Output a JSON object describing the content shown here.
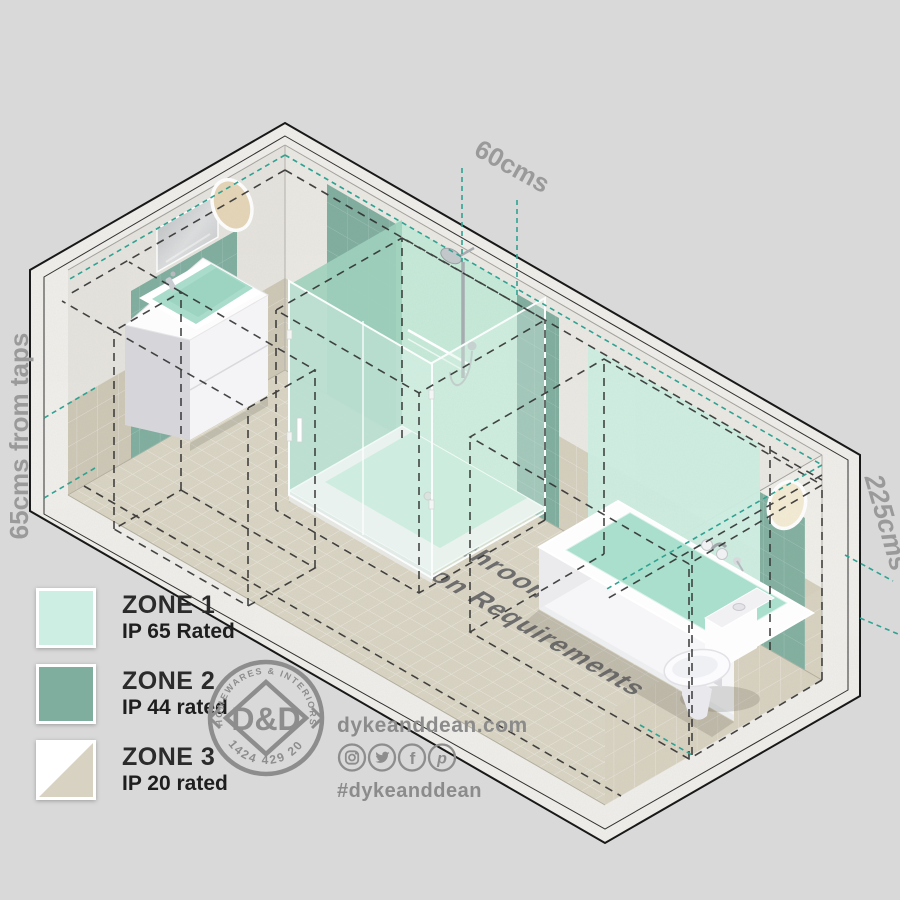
{
  "colors": {
    "background": "#d9d9d9",
    "zone1_mint": "#cdeee2",
    "zone2_green": "#7fae9f",
    "zone3_beige": "#d8d2c3",
    "teal_dash": "#2fa292",
    "black_dash": "#2d2d2d",
    "dim_text": "#9a9a9a",
    "floor_text": "#6d6d6d",
    "brand_grey": "#8d8d8d"
  },
  "dimensions": {
    "top": "60cms",
    "left": "65cms from taps",
    "right": "225cms"
  },
  "floor_title": {
    "line1": "IP Rated Bathroom Lighting",
    "line2": "Zone Position Requirements"
  },
  "legend": {
    "items": [
      {
        "label": "ZONE 1",
        "rating": "IP 65 Rated"
      },
      {
        "label": "ZONE 2",
        "rating": "IP 44 rated"
      },
      {
        "label": "ZONE 3",
        "rating": "IP 20 rated"
      }
    ]
  },
  "stamp": {
    "arc_top": "HOMEWARES & INTERIORS",
    "monogram": "D&D",
    "arc_bottom": "01424 429 202"
  },
  "footer": {
    "website": "dykeanddean.com",
    "hashtag": "#dykeanddean",
    "glyph_f": "f",
    "glyph_p": "p",
    "social": [
      "instagram",
      "twitter",
      "facebook",
      "pinterest"
    ]
  }
}
